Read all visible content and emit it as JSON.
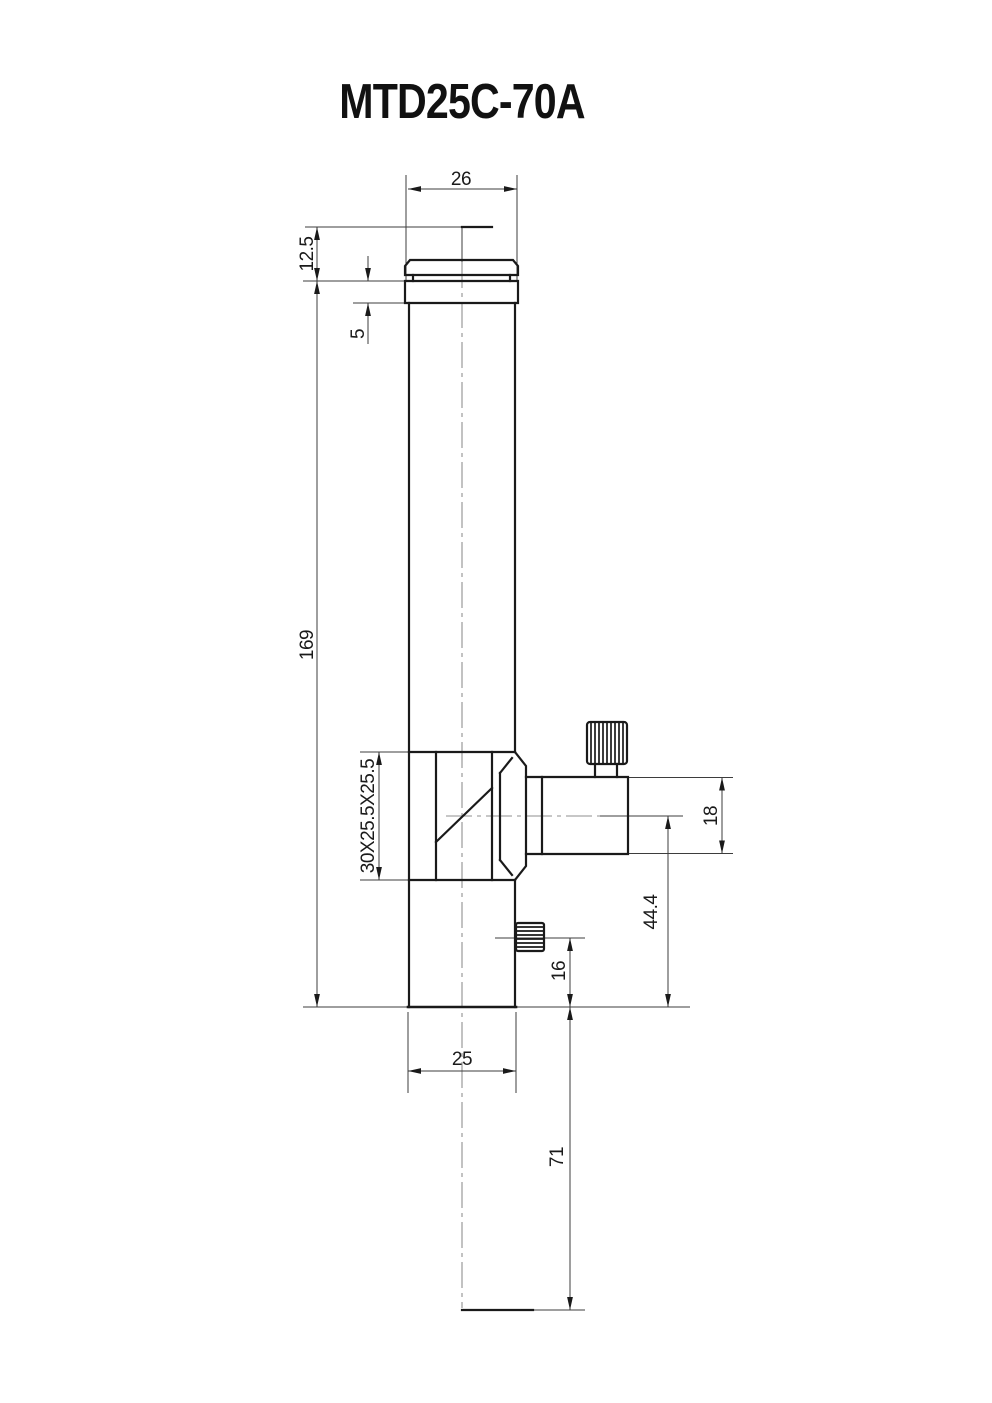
{
  "title": "MTD25C-70A",
  "dims": {
    "top_width": "26",
    "top_offset": "12.5",
    "collar_height": "5",
    "body_length": "169",
    "cube_size": "30X25.5X25.5",
    "side_port_height": "18",
    "port_axis_to_base": "44.4",
    "screw_axis_to_base": "16",
    "base_to_ref": "71",
    "tube_width": "25"
  },
  "colors": {
    "object_line": "#1a1a1a",
    "thin_line": "#3d3d3d",
    "centerline": "#8f8f8f",
    "background": "#ffffff"
  }
}
